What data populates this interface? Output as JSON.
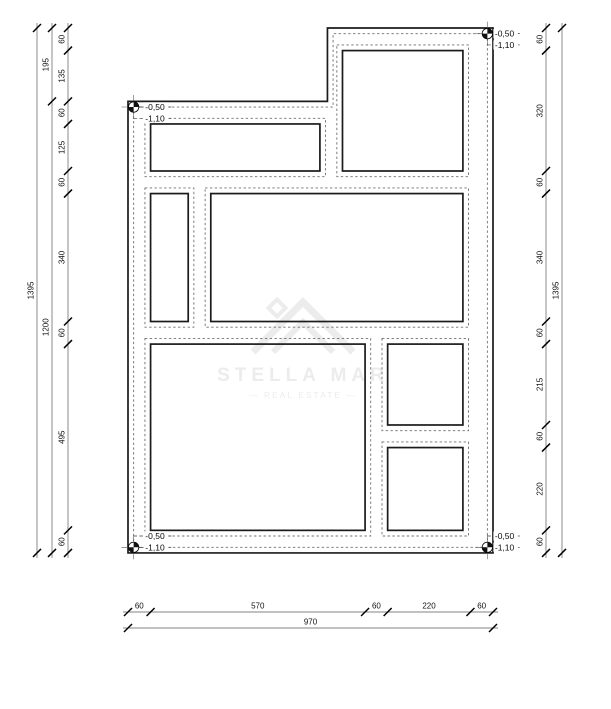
{
  "watermark": {
    "brand": "STELLA MAR",
    "tagline": "— REAL ESTATE —"
  },
  "elevation_markers": [
    {
      "position": "top-left",
      "upper": "-0,50",
      "lower": "-1,10",
      "pos": [
        15,
        210
      ],
      "rows": [
        210,
        240
      ],
      "label_x": 46
    },
    {
      "position": "top-right",
      "upper": "-0,50",
      "lower": "-1,10",
      "pos": [
        955,
        15
      ],
      "rows": [
        15,
        45
      ],
      "label_x": 975
    },
    {
      "position": "bottom-left",
      "upper": "-0,50",
      "lower": "-1,10",
      "pos": [
        15,
        1380
      ],
      "rows": [
        1350,
        1380
      ],
      "label_x": 46
    },
    {
      "position": "bottom-right",
      "upper": "-0,50",
      "lower": "-1,10",
      "pos": [
        955,
        1380
      ],
      "rows": [
        1350,
        1380
      ],
      "label_x": 975
    }
  ],
  "dimensions": {
    "left": {
      "chain": [
        60,
        135,
        60,
        125,
        60,
        340,
        60,
        495,
        60
      ],
      "sub_chain": [
        195,
        1200
      ],
      "total": 1395
    },
    "right": {
      "chain": [
        60,
        320,
        60,
        340,
        60,
        215,
        60,
        220,
        60
      ],
      "total": 1395
    },
    "bottom": {
      "chain": [
        60,
        570,
        60,
        220,
        60
      ],
      "total": 970
    }
  },
  "plan": {
    "units_width": 970,
    "units_height": 1395,
    "footing_offset": 15,
    "outline": [
      [
        0,
        195
      ],
      [
        530,
        195
      ],
      [
        530,
        0
      ],
      [
        970,
        0
      ],
      [
        970,
        1395
      ],
      [
        0,
        1395
      ]
    ],
    "inner_offset": [
      [
        15,
        210
      ],
      [
        545,
        210
      ],
      [
        545,
        15
      ],
      [
        955,
        15
      ],
      [
        955,
        1380
      ],
      [
        15,
        1380
      ]
    ],
    "openings": [
      {
        "name": "top-left-opening",
        "x": 60,
        "y": 255,
        "w": 450,
        "h": 125
      },
      {
        "name": "top-right-opening",
        "x": 570,
        "y": 60,
        "w": 320,
        "h": 320
      },
      {
        "name": "mid-left-opening",
        "x": 60,
        "y": 440,
        "w": 100,
        "h": 340
      },
      {
        "name": "mid-center-opening",
        "x": 220,
        "y": 440,
        "w": 670,
        "h": 340
      },
      {
        "name": "bottom-left-opening",
        "x": 60,
        "y": 840,
        "w": 570,
        "h": 495
      },
      {
        "name": "right-upper-opening",
        "x": 690,
        "y": 840,
        "w": 200,
        "h": 215
      },
      {
        "name": "right-lower-opening",
        "x": 690,
        "y": 1115,
        "w": 200,
        "h": 220
      }
    ]
  }
}
